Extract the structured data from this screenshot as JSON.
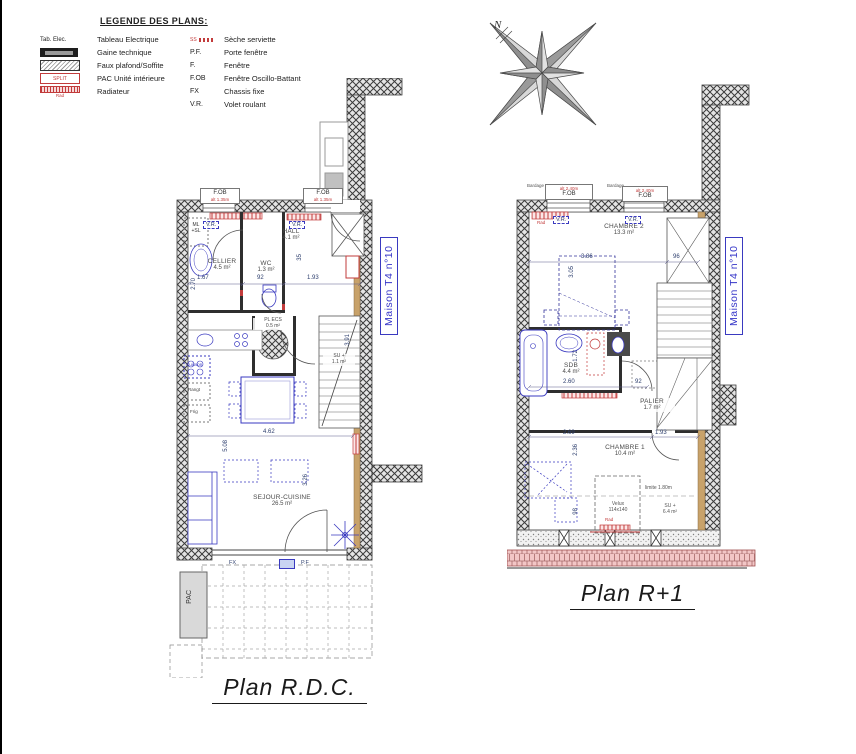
{
  "legend": {
    "title": "LEGENDE DES PLANS:",
    "left": [
      {
        "sym": "Tab. Elec.",
        "label": "Tableau Electrique"
      },
      {
        "sym": "",
        "label": "Gaine technique"
      },
      {
        "sym": "",
        "label": "Faux plafond/Soffite"
      },
      {
        "sym": "SPLIT",
        "label": "PAC Unité intérieure"
      },
      {
        "sym": "Rad",
        "label": "Radiateur"
      }
    ],
    "right": [
      {
        "abbr": "SS",
        "label": "Sèche serviette"
      },
      {
        "abbr": "P.F.",
        "label": "Porte fenêtre"
      },
      {
        "abbr": "F.",
        "label": "Fenêtre"
      },
      {
        "abbr": "F.OB",
        "label": "Fenêtre Oscillo-Battant"
      },
      {
        "abbr": "FX",
        "label": "Chassis fixe"
      },
      {
        "abbr": "V.R.",
        "label": "Volet roulant"
      }
    ]
  },
  "compass": {
    "north": "N"
  },
  "rdc": {
    "title": "Plan R.D.C.",
    "house": "Maison T4 n°10",
    "win": {
      "fob": "F.OB",
      "alt": "alt 1.35m",
      "vr": "V.R."
    },
    "rooms": {
      "hall_name": "HALL",
      "hall_area": "4.1 m²",
      "cellier_name": "CELLIER",
      "cellier_area": "4.5 m²",
      "wc_name": "WC",
      "wc_area": "1.3 m²",
      "plecs_name": "PL ECS",
      "plecs_area": "0.5 m²",
      "sejour_name": "SEJOUR-CUISINE",
      "sejour_area": "26.5 m²",
      "su_name": "SU +",
      "su_area": "1.1 m²"
    },
    "kitchen": {
      "cuisson": "Cuisson",
      "rangt": "Rangt",
      "frig": "Frig"
    },
    "labels": {
      "ml": "ML",
      "sl": "+SL",
      "pac": "PAC",
      "fx": "FX",
      "pf": "P.F"
    },
    "dims": {
      "d1": "2.70",
      "d2": "1.67",
      "d3": "92",
      "d4": "1.93",
      "d5": "35",
      "d6": "3.91",
      "d7": "4.62",
      "d8": "5.08",
      "d9": "3.26"
    }
  },
  "r1": {
    "title": "Plan R+1",
    "house": "Maison T4 n°10",
    "win": {
      "fob": "F.OB",
      "alt": "alt 2.40m",
      "vr": "V.R.",
      "bardage": "Bardage"
    },
    "rooms": {
      "ch2_name": "CHAMBRE 2",
      "ch2_area": "13.3 m²",
      "sdb_name": "SDB",
      "sdb_area": "4.4 m²",
      "palier_name": "PALIER",
      "palier_area": "1.7 m²",
      "ch1_name": "CHAMBRE 1",
      "ch1_area": "10.4 m²"
    },
    "labels": {
      "rad": "Rad",
      "velux": "Velux",
      "velux_size": "114x140",
      "limite": "limite 1.80m",
      "su_name": "SU +",
      "su_area": "6.4 m²"
    },
    "dims": {
      "d1": "3.86",
      "d2": "3.05",
      "d3": "96",
      "d4": "1.72",
      "d5": "2.60",
      "d6": "92",
      "d7": "2.69",
      "d8": "2.36",
      "d9": "1.93",
      "d10": "98"
    }
  }
}
